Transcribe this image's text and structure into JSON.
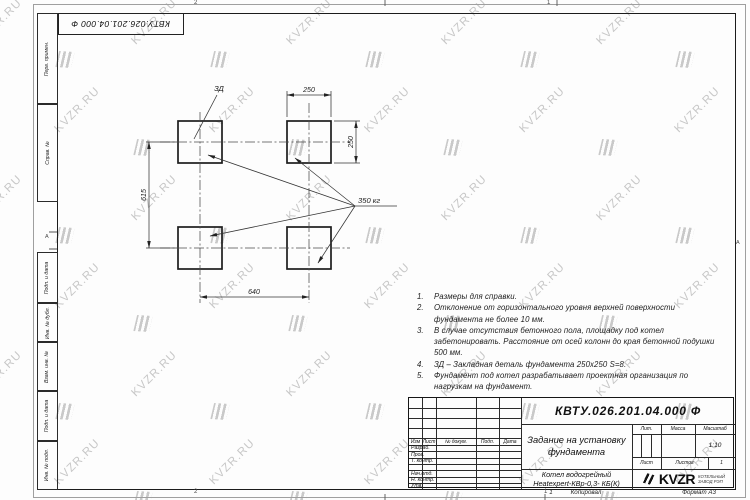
{
  "colors": {
    "line": "#1f1f1f",
    "watermark": "#c7c7c7"
  },
  "watermark": {
    "text": "KVZR.RU"
  },
  "page": {
    "stamp_top": "КВТУ.026.201.04.000 Ф",
    "zones": {
      "top_left": "2",
      "top_right": "1",
      "bottom_left": "2",
      "bottom_right": "1",
      "side_left": "А",
      "side_right": "А"
    },
    "footer": {
      "num": "1",
      "copied": "Копировал",
      "format": "Формат А3"
    }
  },
  "margin_labels": [
    "Перв. примен.",
    "Справ. №",
    "Подп. и дата",
    "Инв. № дубл.",
    "Взам. инв. №",
    "Подп. и дата",
    "Инв. № подл."
  ],
  "drawing": {
    "detail_label": "ЗД",
    "weight_label": "350 кг",
    "dim_top": "250",
    "dim_right": "250",
    "dim_left": "615",
    "dim_bottom": "640"
  },
  "notes": [
    {
      "num": "1.",
      "text": "Размеры для справки."
    },
    {
      "num": "2.",
      "text": "Отклонение от горизонтального уровня верхней поверхности фундамента не более 10 мм."
    },
    {
      "num": "3.",
      "text": "В случае отсутствия бетонного пола, площадку под котел забетонировать. Расстояние от осей колонн до края бетонной подушки 500 мм."
    },
    {
      "num": "4.",
      "text": "ЗД – Закладная деталь фундамента 250х250 S=8."
    },
    {
      "num": "5.",
      "text": "Фундамент под котел разрабатывает проектная организация по нагрузкам на фундамент."
    }
  ],
  "title_block": {
    "doc_number": "КВТУ.026.201.04.000 Ф",
    "title": "Задание на установку фундамента",
    "product_line1": "Котел водогрейный",
    "product_line2": "Heatexpert-КВр-0,3- КБ(К)",
    "rev_header": [
      "Изм",
      "Лист",
      "№ докум.",
      "Подп.",
      "Дата"
    ],
    "sign_rows": [
      "Разраб.",
      "Пров.",
      "Т. контр.",
      "",
      "Нач.отд.",
      "Н. контр.",
      "Утв."
    ],
    "lit_label": "Лит.",
    "mass_label": "Масса",
    "scale_label": "Масштаб",
    "scale_value": "1:10",
    "sheet_label": "Лист",
    "sheets_label": "Листов",
    "sheets_value": "1",
    "logo_text": "KVZR",
    "logo_sub1": "КОТЕЛЬНЫЙ",
    "logo_sub2": "ЗАВОД РЭП"
  }
}
